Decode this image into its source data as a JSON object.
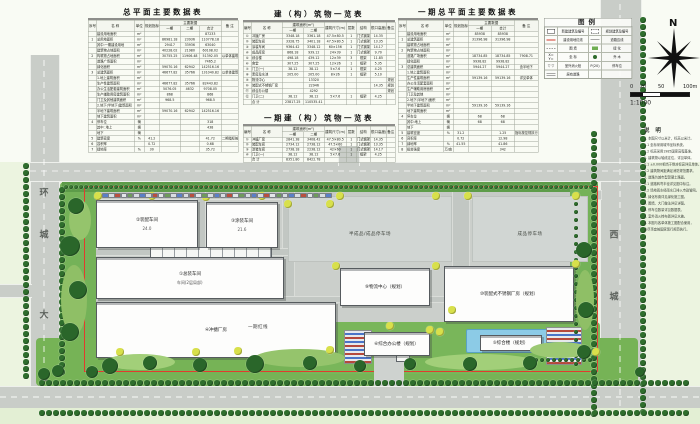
{
  "tables": {
    "site_data": {
      "title": "总平面主要数据表",
      "widths": [
        16,
        76,
        20,
        30,
        42,
        38,
        44,
        34
      ],
      "head": [
        [
          {
            "t": "序号",
            "rs": 2
          },
          {
            "t": "名  称",
            "rs": 2
          },
          {
            "t": "单位",
            "rs": 2
          },
          {
            "t": "规划指标",
            "rs": 2
          },
          {
            "t": "主要数据",
            "cs": 3
          },
          {
            "t": "备  注",
            "rs": 2
          }
        ],
        [
          {
            "t": "一期"
          },
          {
            "t": "二期"
          },
          {
            "t": "合计"
          }
        ]
      ],
      "rows": [
        [
          "",
          "建设用地面积",
          "m²",
          "",
          "",
          "",
          "87233",
          ""
        ],
        [
          "1",
          "总用地面积",
          "m²",
          "",
          "86981.18",
          "23936",
          "110778.18",
          ""
        ],
        [
          "",
          "其中:一期建设用地",
          "m²",
          "",
          "29417",
          "33936",
          "63040",
          ""
        ],
        [
          "",
          "建筑物占地面积",
          "m²",
          "",
          "40228.02",
          "21980",
          "60108.02",
          ""
        ],
        [
          "2",
          "构筑物占地面积",
          "m²",
          "",
          "30755.25",
          "11906.48",
          "51392.05",
          "以单体建筑面积计"
        ],
        [
          "",
          "道路广场面积",
          "m²",
          "",
          "",
          "",
          "7465.2",
          ""
        ],
        [
          "",
          "绿化面积",
          "m²",
          "",
          "59070.16",
          "62942",
          "142516.16",
          ""
        ],
        [
          "3",
          "总建筑面积",
          "m²",
          "",
          "46677.82",
          "35766",
          "131040.82",
          "以单体建筑面积计"
        ],
        [
          "",
          "1.地上建筑面积",
          "m²",
          "",
          "",
          "",
          "",
          ""
        ],
        [
          "",
          "生产性建筑面积",
          "m²",
          "",
          "46677.82",
          "35766",
          "82443.82",
          ""
        ],
        [
          "",
          "办公生活配套建筑面积",
          "m²",
          "",
          "5076.05",
          "4632",
          "9708.05",
          ""
        ],
        [
          "",
          "生产辅助用房建筑面积",
          "m²",
          "",
          "868",
          "",
          "868",
          ""
        ],
        [
          "",
          "门卫及其他建筑面积",
          "m²",
          "",
          "968.5",
          "",
          "968.5",
          ""
        ],
        [
          "",
          "2.地下(半地下)建筑面积",
          "m²",
          "",
          "",
          "",
          "",
          ""
        ],
        [
          "",
          "半地下建筑面积",
          "m²",
          "",
          "59070.16",
          "62942",
          "142516.16",
          ""
        ],
        [
          "",
          "地下建筑面积",
          "m²",
          "",
          "",
          "",
          "",
          ""
        ],
        [
          "4",
          "停车位",
          "辆",
          "",
          "",
          "",
          "318",
          ""
        ],
        [
          "",
          "其中: 地上",
          "辆",
          "",
          "",
          "",
          "438",
          ""
        ],
        [
          "",
          "地下",
          "辆",
          "",
          "",
          "",
          "",
          ""
        ],
        [
          "5",
          "建筑密度",
          "%",
          "41.2",
          "",
          "",
          "41.72",
          "二期指标按控规执行"
        ],
        [
          "6",
          "容积率",
          "",
          "0.72",
          "",
          "",
          "0.68",
          ""
        ],
        [
          "7",
          "绿地率",
          "%",
          "30",
          "",
          "",
          "35.72",
          ""
        ]
      ]
    },
    "buildings_list": {
      "title": "建（构）筑物一览表",
      "widths": [
        16,
        62,
        42,
        42,
        44,
        20,
        28,
        32,
        18
      ],
      "head": [
        [
          {
            "t": "编号",
            "rs": 2
          },
          {
            "t": "名  称",
            "rs": 2
          },
          {
            "t": "建筑面积(m²)",
            "cs": 2
          },
          {
            "t": "建筑尺寸(m)",
            "rs": 2
          },
          {
            "t": "层数",
            "rs": 2
          },
          {
            "t": "结构",
            "rs": 2
          },
          {
            "t": "檐口高度(m)",
            "rs": 2
          },
          {
            "t": "备注",
            "rs": 2
          }
        ],
        [
          {
            "t": "一期"
          },
          {
            "t": "二期"
          }
        ]
      ],
      "rows": [
        [
          "①",
          "冲搪厂房",
          "3348.18",
          "3361.18",
          "47.5×80.5",
          "1",
          "门式钢架",
          "14.35",
          ""
        ],
        [
          "②",
          "装配车间",
          "3328.75",
          "3401.18",
          "47.5×80.5",
          "1",
          "门式钢架",
          "13.35",
          ""
        ],
        [
          "③",
          "涂装车间",
          "9364.42",
          "3348.12",
          "60×156",
          "1",
          "门式钢架",
          "14.17",
          ""
        ],
        [
          "④",
          "成品库房",
          "868.18",
          "939.12",
          "24×39",
          "1",
          "门式钢架",
          "9.70",
          ""
        ],
        [
          "⑤",
          "综合楼",
          "498.18",
          "439.12",
          "12×39",
          "3",
          "框架",
          "11.85",
          ""
        ],
        [
          "⑥",
          "食堂",
          "307.25",
          "307.25",
          "12×26",
          "1",
          "框架",
          "5.35",
          ""
        ],
        [
          "⑦",
          "门卫(一)",
          "38.12",
          "38.12",
          "5×7.6",
          "1",
          "框架",
          "4.25",
          ""
        ],
        [
          "⑧",
          "泵房及水池",
          "205.00",
          "205.00",
          "8×26",
          "1",
          "框架",
          "5.10",
          ""
        ],
        [
          "⑨",
          "物流中心",
          "",
          "13320",
          "",
          "",
          "",
          "",
          "规划"
        ],
        [
          "⑩",
          "装配式不锈钢厂房",
          "",
          "22946",
          "",
          "",
          "",
          "14.35",
          "规划"
        ],
        [
          "⑪",
          "综合办公楼",
          "",
          "4292",
          "",
          "",
          "",
          "",
          "规划"
        ],
        [
          "⑫",
          "门卫(二)",
          "38.12",
          "38.12",
          "5×7.6",
          "1",
          "框架",
          "4.25",
          ""
        ],
        [
          "",
          "合  计",
          "23817.25",
          "110535.41",
          "",
          "",
          "",
          "",
          ""
        ]
      ]
    },
    "phase1_buildings": {
      "title": "一期建（构）筑物一览表",
      "widths": [
        16,
        62,
        42,
        42,
        44,
        20,
        28,
        32,
        18
      ],
      "head": [
        [
          {
            "t": "编号",
            "rs": 2
          },
          {
            "t": "名  称",
            "rs": 2
          },
          {
            "t": "建筑面积(m²)",
            "cs": 2
          },
          {
            "t": "建筑尺寸(m)",
            "rs": 2
          },
          {
            "t": "层数",
            "rs": 2
          },
          {
            "t": "结构",
            "rs": 2
          },
          {
            "t": "檐口高度(m)",
            "rs": 2
          },
          {
            "t": "备注",
            "rs": 2
          }
        ],
        [
          {
            "t": "一期"
          },
          {
            "t": "二期"
          }
        ]
      ],
      "rows": [
        [
          "①",
          "冲搪厂房",
          "2841.38",
          "3408.42",
          "47.5×80.5",
          "1",
          "门式钢架",
          "14.35",
          ""
        ],
        [
          "②",
          "装配车间",
          "2734.12",
          "2738.12",
          "47.5×60",
          "1",
          "门式钢架",
          "13.35",
          ""
        ],
        [
          "③",
          "涂装车间",
          "2738.18",
          "2238.12",
          "42×60",
          "1",
          "门式钢架",
          "14.17",
          ""
        ],
        [
          "④",
          "门卫(一)",
          "38.12",
          "38.12",
          "5×7.6",
          "1",
          "框架",
          "4.25",
          ""
        ],
        [
          "",
          "合  计",
          "8351.80",
          "8422.78",
          "",
          "",
          "",
          "",
          ""
        ]
      ]
    },
    "phase1_site_data": {
      "title": "一期总平面主要数据表",
      "widths": [
        16,
        74,
        20,
        30,
        46,
        46,
        48
      ],
      "head": [
        [
          {
            "t": "序号",
            "rs": 2
          },
          {
            "t": "名  称",
            "rs": 2
          },
          {
            "t": "单位",
            "rs": 2
          },
          {
            "t": "规划指标",
            "rs": 2
          },
          {
            "t": "主要数据",
            "cs": 2
          },
          {
            "t": "备  注",
            "rs": 2
          }
        ],
        [
          {
            "t": "一期"
          },
          {
            "t": "合计"
          }
        ]
      ],
      "rows": [
        [
          "",
          "建设用地面积",
          "m²",
          "",
          "85938",
          "85938",
          ""
        ],
        [
          "1",
          "总建筑面积",
          "m²",
          "",
          "31396.98",
          "31396.98",
          ""
        ],
        [
          "",
          "建筑物占地面积",
          "m²",
          "",
          "",
          "",
          ""
        ],
        [
          "2",
          "构筑物占地面积",
          "m²",
          "",
          "",
          "",
          ""
        ],
        [
          "",
          "道路广场面积",
          "m²",
          "",
          "18734.85",
          "18734.85",
          "7908.71"
        ],
        [
          "",
          "绿化面积",
          "m²",
          "",
          "9938.82",
          "9938.82",
          ""
        ],
        [
          "3",
          "总建筑面积",
          "m²",
          "",
          "5944.27",
          "5944.27",
          "含半地下"
        ],
        [
          "",
          "1.地上建筑面积",
          "m²",
          "",
          "",
          "",
          ""
        ],
        [
          "",
          "生产性建筑面积",
          "m²",
          "",
          "59139.16",
          "59139.16",
          "详见单体"
        ],
        [
          "",
          "办公生活配套面积",
          "m²",
          "",
          "",
          "",
          ""
        ],
        [
          "",
          "生产辅助用房面积",
          "m²",
          "",
          "",
          "",
          ""
        ],
        [
          "",
          "门卫及其他",
          "m²",
          "",
          "",
          "",
          ""
        ],
        [
          "",
          "2.地下(半地下)面积",
          "m²",
          "",
          "",
          "",
          ""
        ],
        [
          "",
          "半地下建筑面积",
          "m²",
          "",
          "59139.16",
          "59139.16",
          ""
        ],
        [
          "",
          "地下建筑面积",
          "m²",
          "",
          "",
          "",
          ""
        ],
        [
          "4",
          "停车位",
          "辆",
          "",
          "68",
          "68",
          ""
        ],
        [
          "",
          "其中:地上",
          "辆",
          "",
          "68",
          "68",
          ""
        ],
        [
          "",
          "地下",
          "辆",
          "",
          "",
          "",
          ""
        ],
        [
          "5",
          "建筑密度",
          "%",
          "31.2",
          "",
          "1.25",
          "指标按控规执行"
        ],
        [
          "6",
          "容积率",
          "",
          "0.72",
          "",
          "12.98",
          ""
        ],
        [
          "7",
          "绿地率",
          "%",
          "41.55",
          "",
          "41.86",
          ""
        ],
        [
          "8",
          "投资强度",
          "万/亩",
          "",
          "",
          "342",
          ""
        ]
      ]
    }
  },
  "legend": {
    "title": "图例",
    "items": [
      {
        "sym": "new",
        "label": "新建建筑及编号"
      },
      {
        "sym": "plan",
        "label": "规划建筑及编号"
      },
      {
        "sym": "redline",
        "label": "建设用地红线"
      },
      {
        "sym": "roadline",
        "label": "道路边线"
      },
      {
        "sym": "fence",
        "label": "围  墙"
      },
      {
        "sym": "green",
        "label": "绿  化"
      },
      {
        "sym": "coord",
        "sym_text": "X=  Y=",
        "label": "坐  标"
      },
      {
        "sym": "tree",
        "label": "乔  木"
      },
      {
        "sym": "hydrant",
        "sym_text": "▽ ▽",
        "label": "室外消火栓"
      },
      {
        "sym": "parking",
        "sym_text": "P(20)",
        "label": "停车位"
      },
      {
        "sym": "oldroad",
        "label": "原有道路"
      },
      {
        "sym": "none",
        "label": ""
      }
    ]
  },
  "compass": {
    "north_label": "N"
  },
  "scale_bar": {
    "labels": [
      "0",
      "20",
      "50",
      "100m"
    ],
    "ratio": "1:1000"
  },
  "notes": {
    "title": "说  明",
    "lines": [
      "1. 本图尺寸以米计，标高以米计。",
      "1.1 坐标采用城市坐标系统。",
      "1.2 标高采用1985国家高程基准。",
      "2. 建筑物以轴线定位，详见单体。",
      "2.1 ±0.000相当于绝对标高详见单体。",
      "2.2 建筑物间距满足消防规范要求。",
      "3. 道路为城市型混凝土路面。",
      "3.1 道路转弯半径详见图中标注。",
      "3.2 场地雨水经雨水口排入市政管网。",
      "4. 绿化布置详见绿化施工图。",
      "5. 围墙、大门做法详见详图。",
      "6. 停车位数量详见数据表。",
      "7. 室外消火栓布置详见水施。",
      "8. 本图与各单体施工图配合使用，",
      "   未尽事宜按国家现行规范执行。"
    ]
  },
  "plan": {
    "road_names": {
      "west": [
        "环",
        "城",
        "大",
        "道"
      ],
      "east": [
        "西",
        "城"
      ]
    },
    "yards": [
      {
        "label": "半成品/成品停车场",
        "x": 288,
        "y": 196,
        "w": 164,
        "h": 66
      },
      {
        "label": "成品停车场",
        "x": 472,
        "y": 196,
        "w": 116,
        "h": 66
      }
    ],
    "buildings": [
      {
        "label": "②装配车间",
        "note": "24.0",
        "x": 96,
        "y": 200,
        "w": 100,
        "h": 46
      },
      {
        "label": "③涂装车间",
        "note": "21.6",
        "x": 206,
        "y": 202,
        "w": 70,
        "h": 44
      },
      {
        "label": "①总装车间",
        "note": "车间(2层局部)",
        "x": 96,
        "y": 257,
        "w": 186,
        "h": 40
      },
      {
        "label": "⑨物流中心（规划）",
        "note": "",
        "x": 340,
        "y": 268,
        "w": 88,
        "h": 36
      },
      {
        "label": "⑩装配式不锈钢厂房（规划）",
        "note": "",
        "x": 444,
        "y": 266,
        "w": 128,
        "h": 54
      },
      {
        "label": "④冲搪厂房",
        "note": "",
        "x": 96,
        "y": 302,
        "w": 238,
        "h": 54
      },
      {
        "label": "⑥综合办公楼（规划）",
        "note": "",
        "x": 364,
        "y": 332,
        "w": 64,
        "h": 22
      },
      {
        "label": "⑤综合楼（规划）",
        "note": "",
        "x": 480,
        "y": 335,
        "w": 60,
        "h": 14
      }
    ],
    "annotations": [
      {
        "text": "一期红线",
        "x": 258,
        "y": 326
      }
    ],
    "colors": {
      "road": "#c9cdc8",
      "site": "#cbcfcb",
      "green_dark": "#2e6b2c",
      "green_mid": "#6fae52",
      "green_light": "#a2cf79",
      "red_line": "#e23b2e",
      "water": "#8ccbe6",
      "building": "#fdfdfc"
    }
  }
}
